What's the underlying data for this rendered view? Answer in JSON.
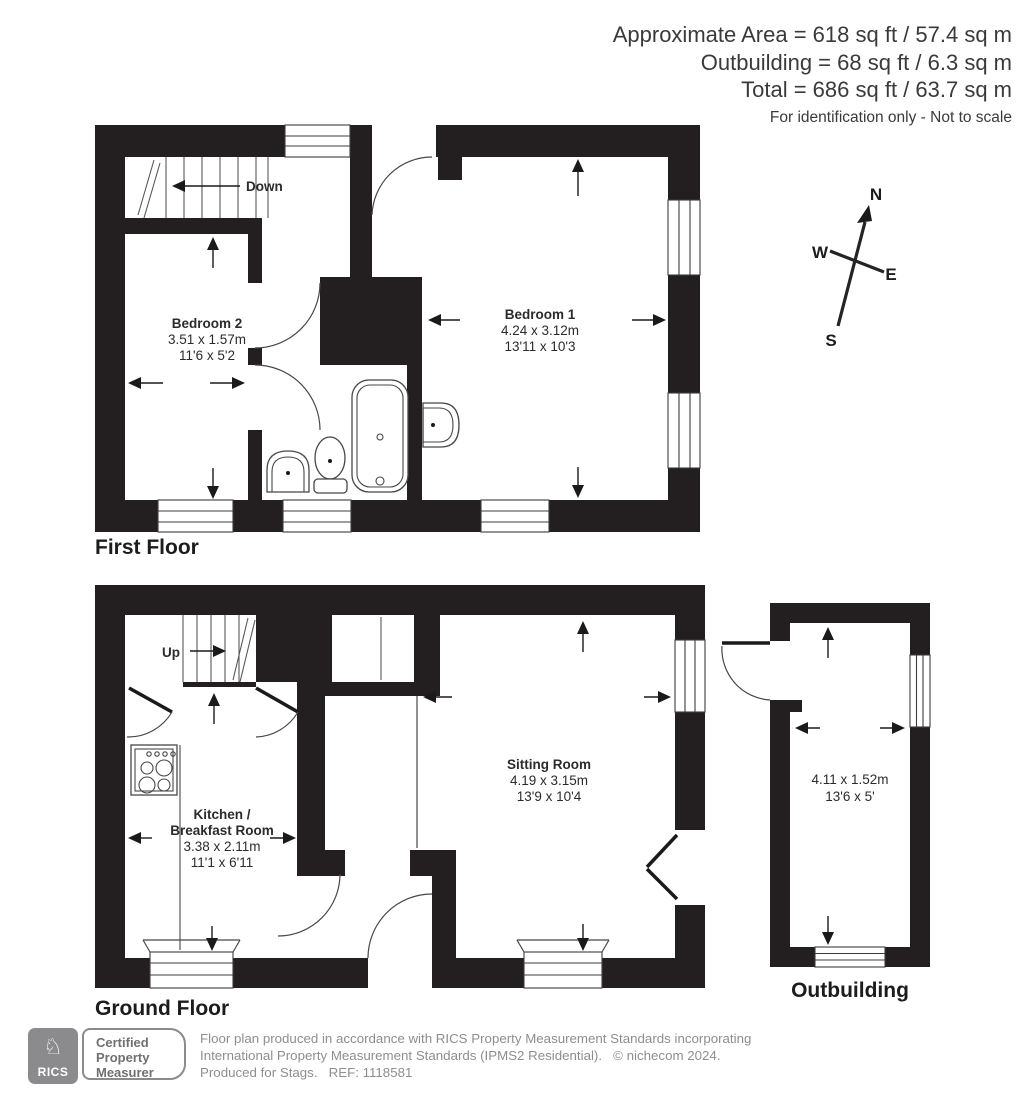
{
  "header": {
    "line1": "Approximate Area = 618 sq ft / 57.4 sq m",
    "line2": "Outbuilding = 68 sq ft / 6.3 sq m",
    "line3": "Total = 686 sq ft / 63.7 sq m",
    "disclaimer": "For identification only - Not to scale"
  },
  "compass": {
    "north": "N",
    "west": "W",
    "east": "E",
    "south": "S"
  },
  "first_floor": {
    "label": "First Floor",
    "stairs_label": "Down",
    "bedroom2": {
      "name": "Bedroom 2",
      "metric": "3.51 x 1.57m",
      "imperial": "11'6 x 5'2"
    },
    "bedroom1": {
      "name": "Bedroom 1",
      "metric": "4.24 x 3.12m",
      "imperial": "13'11 x 10'3"
    }
  },
  "ground_floor": {
    "label": "Ground Floor",
    "stairs_label": "Up",
    "kitchen": {
      "name_line1": "Kitchen /",
      "name_line2": "Breakfast Room",
      "metric": "3.38 x 2.11m",
      "imperial": "11'1 x 6'11"
    },
    "sitting_room": {
      "name": "Sitting Room",
      "metric": "4.19 x 3.15m",
      "imperial": "13'9 x 10'4"
    }
  },
  "outbuilding": {
    "label": "Outbuilding",
    "metric": "4.11 x 1.52m",
    "imperial": "13'6 x 5'"
  },
  "footer": {
    "rics_label": "RICS",
    "badge_line1": "Certified",
    "badge_line2": "Property",
    "badge_line3": "Measurer",
    "disclaimer_line1": "Floor plan produced in accordance with RICS Property Measurement Standards incorporating",
    "disclaimer_line2": "International Property Measurement Standards (IPMS2 Residential).   © nichecom 2024.",
    "disclaimer_line3": "Produced for Stags.   REF: 1118581"
  },
  "colors": {
    "wall": "#231f20",
    "line": "#474747",
    "text": "#2b2b2b",
    "muted": "#8e8e90"
  }
}
